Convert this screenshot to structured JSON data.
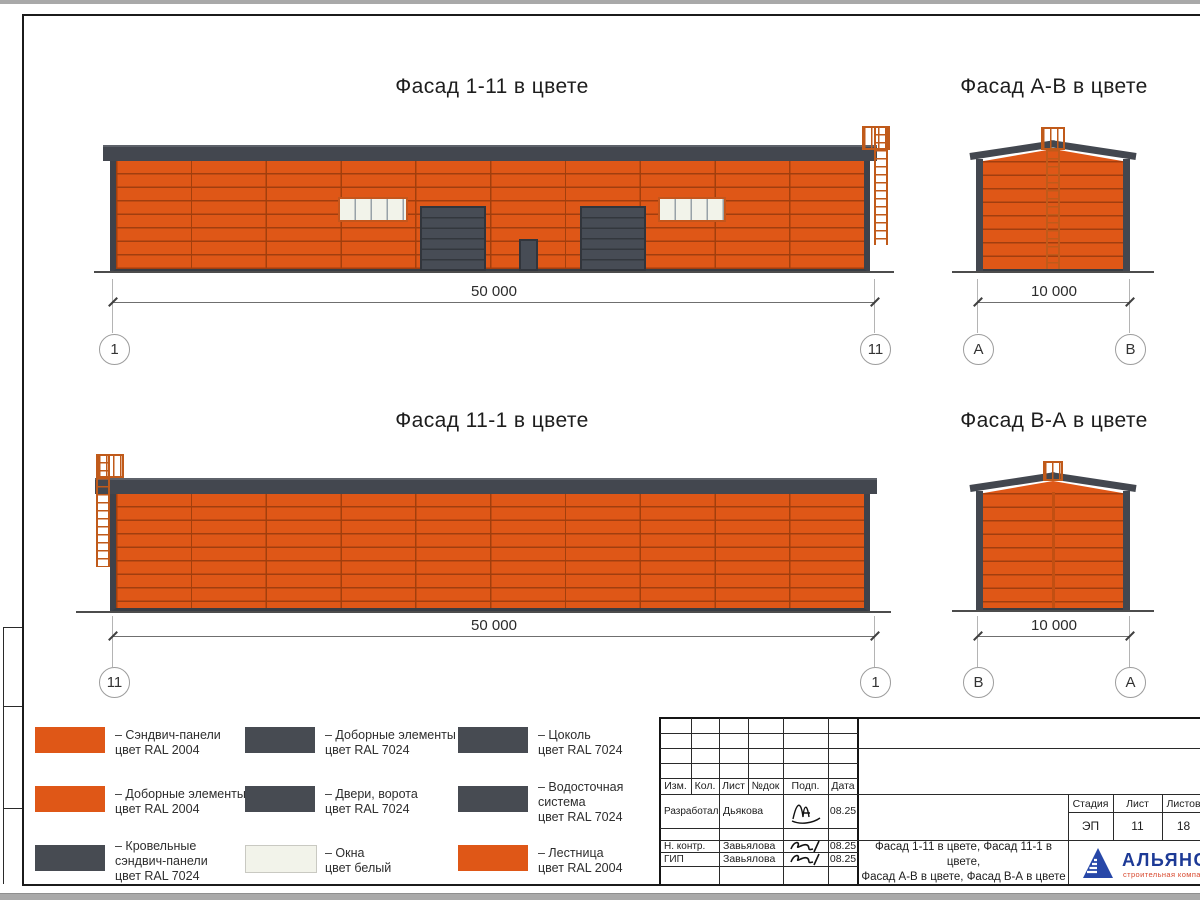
{
  "colors": {
    "wall_orange": "#DF5717",
    "roof_gray": "#43474F",
    "door_gray": "#474C55",
    "window_white": "#F2F3EA",
    "ladder_orange": "#C05A1A",
    "legend_dark": "#474B52",
    "legend_white": "#F2F3EA",
    "logo_blue": "#1D3A96",
    "logo_red": "#D8482E"
  },
  "elevations": {
    "f1_11": {
      "title": "Фасад 1-11 в цвете",
      "dim": "50 000",
      "axis_left": "1",
      "axis_right": "11"
    },
    "fA_B": {
      "title": "Фасад А-В в цвете",
      "dim": "10 000",
      "axis_left": "А",
      "axis_right": "В"
    },
    "f11_1": {
      "title": "Фасад 11-1 в цвете",
      "dim": "50 000",
      "axis_left": "11",
      "axis_right": "1"
    },
    "fB_A": {
      "title": "Фасад В-А в цвете",
      "dim": "10 000",
      "axis_left": "В",
      "axis_right": "А"
    }
  },
  "legend": {
    "items": [
      {
        "color": "#DF5717",
        "text": "– Сэндвич-панели\nцвет RAL 2004"
      },
      {
        "color": "#DF5717",
        "text": "– Доборные элементы\nцвет RAL 2004"
      },
      {
        "color": "#474B52",
        "text": "– Кровельные\nсэндвич-панели\nцвет RAL 7024"
      },
      {
        "color": "#474B52",
        "text": "– Доборные элементы\nцвет RAL 7024"
      },
      {
        "color": "#474B52",
        "text": "– Двери, ворота\nцвет RAL 7024"
      },
      {
        "color": "#F2F3EA",
        "text": "– Окна\nцвет белый"
      },
      {
        "color": "#474B52",
        "text": "– Цоколь\nцвет RAL 7024"
      },
      {
        "color": "#474B52",
        "text": "– Водосточная\nсистема\nцвет RAL 7024"
      },
      {
        "color": "#DF5717",
        "text": "– Лестница\nцвет RAL 2004"
      }
    ]
  },
  "titleblock": {
    "columns": [
      "Изм.",
      "Кол.",
      "Лист",
      "№док",
      "Подп.",
      "Дата"
    ],
    "rows": [
      {
        "role": "Разработал",
        "name": "Дьякова",
        "date": "08.25"
      },
      {
        "role": "Н. контр.",
        "name": "Завьялова",
        "date": "08.25"
      },
      {
        "role": "ГИП",
        "name": "Завьялова",
        "date": "08.25"
      }
    ],
    "stage_label": "Стадия",
    "sheet_label": "Лист",
    "sheets_label": "Листов",
    "stage": "ЭП",
    "sheet_no": "11",
    "sheets_total": "18",
    "doc_title": "Фасад 1-11 в цвете, Фасад 11-1 в цвете,\nФасад А-В в цвете, Фасад В-А в цвете",
    "logo": {
      "name": "АЛЬЯНС",
      "tagline": "строительная компания"
    }
  }
}
